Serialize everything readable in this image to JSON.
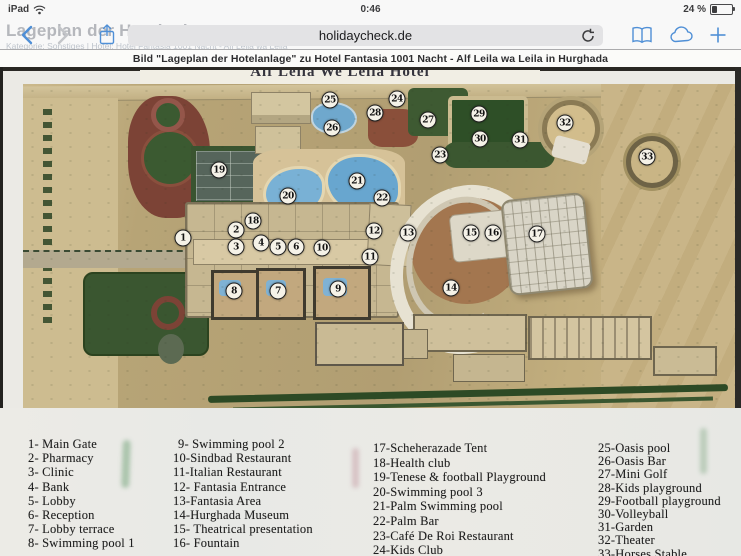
{
  "status_bar": {
    "device": "iPad",
    "time": "0:46",
    "battery": "24 %"
  },
  "toolbar": {
    "url": "holidaycheck.de",
    "background_heading": "Lageplan der Hotelanlage",
    "background_subline": "Kategorie: Sonstiges | Hotel: Hotel Fantasia 1001 Nacht - Alf Leila wa Leila"
  },
  "caption": "Bild \"Lageplan der Hotelanlage\" zu Hotel Fantasia 1001 Nacht - Alf Leila wa Leila in Hurghada",
  "icons": {
    "wifi": "wifi-icon",
    "battery": "battery-icon",
    "back": "chevron-left-icon",
    "forward": "chevron-right-icon",
    "share": "share-icon",
    "reload": "reload-icon",
    "bookmarks": "book-icon",
    "icloud_tabs": "cloud-icon",
    "new_tab": "plus-icon"
  },
  "map": {
    "title": "Alf Leila We Leila Hotel",
    "markers": [
      {
        "n": "1",
        "x": 160,
        "y": 154
      },
      {
        "n": "2",
        "x": 213,
        "y": 146
      },
      {
        "n": "3",
        "x": 213,
        "y": 163
      },
      {
        "n": "4",
        "x": 238,
        "y": 159
      },
      {
        "n": "5",
        "x": 255,
        "y": 163
      },
      {
        "n": "6",
        "x": 273,
        "y": 163
      },
      {
        "n": "7",
        "x": 255,
        "y": 207
      },
      {
        "n": "8",
        "x": 211,
        "y": 207
      },
      {
        "n": "9",
        "x": 315,
        "y": 205
      },
      {
        "n": "10",
        "x": 299,
        "y": 164
      },
      {
        "n": "11",
        "x": 347,
        "y": 173
      },
      {
        "n": "12",
        "x": 351,
        "y": 147
      },
      {
        "n": "13",
        "x": 385,
        "y": 149
      },
      {
        "n": "14",
        "x": 428,
        "y": 204
      },
      {
        "n": "15",
        "x": 448,
        "y": 149
      },
      {
        "n": "16",
        "x": 470,
        "y": 149
      },
      {
        "n": "17",
        "x": 514,
        "y": 150
      },
      {
        "n": "18",
        "x": 230,
        "y": 137
      },
      {
        "n": "19",
        "x": 196,
        "y": 86
      },
      {
        "n": "20",
        "x": 265,
        "y": 112
      },
      {
        "n": "21",
        "x": 334,
        "y": 97
      },
      {
        "n": "22",
        "x": 359,
        "y": 114
      },
      {
        "n": "23",
        "x": 417,
        "y": 71
      },
      {
        "n": "24",
        "x": 374,
        "y": 15
      },
      {
        "n": "25",
        "x": 307,
        "y": 16
      },
      {
        "n": "26",
        "x": 309,
        "y": 44
      },
      {
        "n": "27",
        "x": 405,
        "y": 36
      },
      {
        "n": "28",
        "x": 352,
        "y": 29
      },
      {
        "n": "29",
        "x": 456,
        "y": 30
      },
      {
        "n": "30",
        "x": 457,
        "y": 55
      },
      {
        "n": "31",
        "x": 497,
        "y": 56
      },
      {
        "n": "32",
        "x": 542,
        "y": 39
      },
      {
        "n": "33",
        "x": 624,
        "y": 73
      }
    ]
  },
  "legend": {
    "columns": [
      {
        "items": [
          "1- Main Gate",
          "2- Pharmacy",
          "3- Clinic",
          "4- Bank",
          "5- Lobby",
          "6- Reception",
          "7- Lobby terrace",
          "8- Swimming pool 1"
        ]
      },
      {
        "items": [
          "9- Swimming pool 2",
          "10-Sindbad Restaurant",
          "11-Italian Restaurant",
          "12- Fantasia Entrance",
          "13-Fantasia Area",
          "14-Hurghada Museum",
          "15- Theatrical presentation",
          "16- Fountain"
        ]
      },
      {
        "items": [
          "17-Scheherazade Tent",
          "18-Health club",
          "19-Tenese & football Playground",
          "20-Swimming pool 3",
          "21-Palm Swimming pool",
          "22-Palm Bar",
          "23-Café De Roi Restaurant",
          "24-Kids Club"
        ]
      },
      {
        "items": [
          "25-Oasis pool",
          "26-Oasis Bar",
          "27-Mini Golf",
          "28-Kids playground",
          "29-Football playground",
          "30-Volleyball",
          "31-Garden",
          "32-Theater",
          "33-Horses Stable"
        ]
      }
    ]
  }
}
